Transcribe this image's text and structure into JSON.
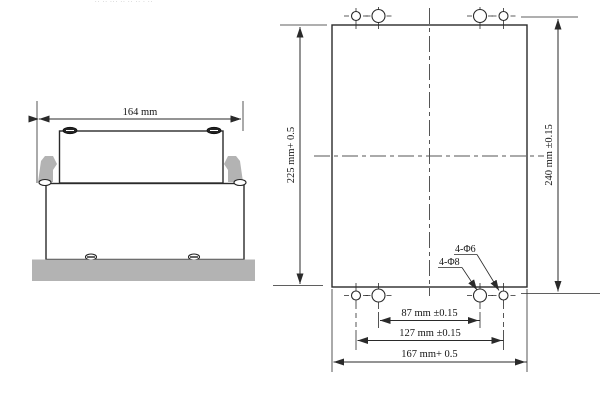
{
  "page": {
    "cropped_header_fragments": "·· ··  ···  ·· ··   ·· ·  ··"
  },
  "colors": {
    "line": "#2a2a2a",
    "gray_fill": "#b3b3b3",
    "text": "#141414"
  },
  "side_view": {
    "description": "side elevation of unit clipped on mounting plate",
    "width_dim_label": "164 mm"
  },
  "panel_view": {
    "description": "panel cutout and drilling plan",
    "cutout_height_label": "225 mm+ 0.5",
    "hole_rows_spacing_label": "240 mm ±0.15",
    "inner_hole_spacing_label": "87 mm ±0.15",
    "outer_hole_spacing_label": "127 mm ±0.15",
    "cutout_width_label": "167 mm+ 0.5",
    "phi6_callout_label": "4-Φ6",
    "phi8_callout_label": "4-Φ8"
  }
}
